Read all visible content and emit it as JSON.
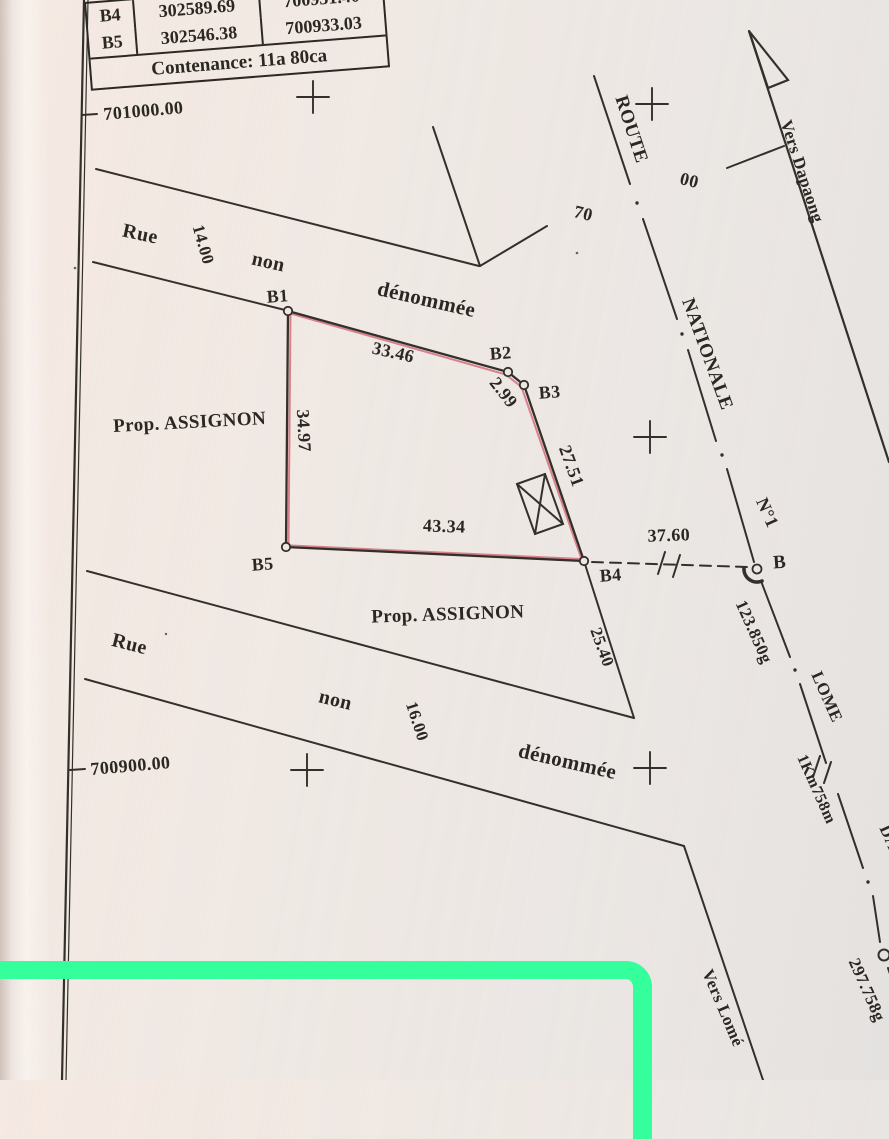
{
  "table": {
    "rows": [
      {
        "point": "B4",
        "x": "302589.69",
        "y": "700931.40"
      },
      {
        "point": "B5",
        "x": "302546.38",
        "y": "700933.03"
      }
    ],
    "contenance": "Contenance: 11a  80ca"
  },
  "grid": {
    "y_line_top": "701000.00",
    "y_line_bottom": "700900.00"
  },
  "parcel": {
    "corner_b1": "B1",
    "corner_b2": "B2",
    "corner_b3": "B3",
    "corner_b4": "B4",
    "corner_b5": "B5",
    "len_b1_b2": "33.46",
    "len_b2_b3": "2.99",
    "len_b3_b4": "27.51",
    "len_b5_b4": "43.34",
    "len_b1_b5": "34.97",
    "owner_west": "Prop. ASSIGNON",
    "owner_south": "Prop. ASSIGNON"
  },
  "street_north": {
    "word_rue": "Rue",
    "word_non": "non",
    "word_denommee": "dénommée",
    "width": "14.00"
  },
  "street_south": {
    "word_rue": "Rue",
    "word_non": "non",
    "word_denommee": "dénommée",
    "width": "16.00"
  },
  "route": {
    "word_route": "ROUTE",
    "word_nationale": "NATIONALE",
    "word_n1": "N°1",
    "num_70": "70",
    "num_00": "00",
    "vers_dapaong": "Vers Dapaong",
    "vers_lome": "Vers Lomé",
    "point_b": "B",
    "tie_b4_b": "37.60",
    "len_b4_corner": "25.40",
    "angle_b": "123.850g",
    "lome": "LOME",
    "km": "1Km758m",
    "dapaong": "DAPAONG",
    "bearing": "297.758g"
  }
}
